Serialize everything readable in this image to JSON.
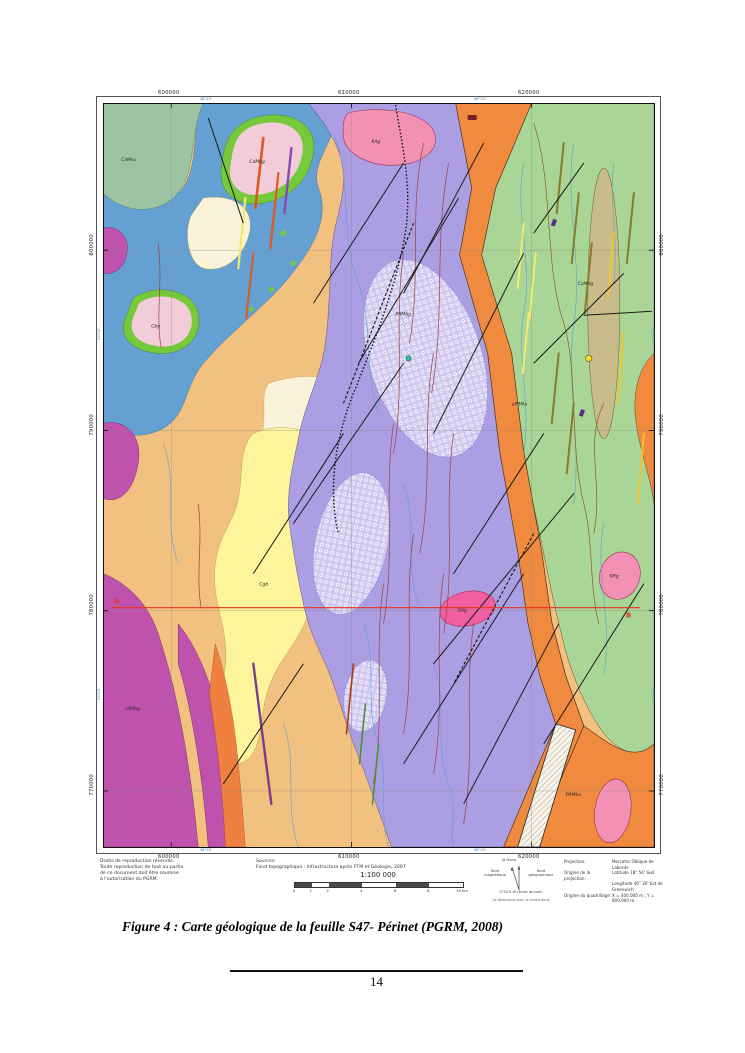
{
  "figure_caption": "Figure 4 : Carte géologique de la feuille S47- Périnet (PGRM, 2008)",
  "page_number": "14",
  "map": {
    "grid": {
      "top": [
        "600000",
        "610000",
        "620000"
      ],
      "bottom": [
        "600000",
        "610000",
        "620000"
      ],
      "left": [
        "800000",
        "790000",
        "780000",
        "770000"
      ],
      "right": [
        "800000",
        "790000",
        "780000",
        "770000"
      ],
      "geo_top": [
        "48°15'",
        "48°20'"
      ],
      "geo_bottom": [
        "48°15'",
        "48°20'"
      ],
      "geo_left": [
        "19°00'",
        "19°05'"
      ],
      "geo_right": [
        "19°00'",
        "19°05'"
      ]
    },
    "section": {
      "start": "A",
      "end": "B"
    },
    "units": [
      {
        "t": "CaMsu"
      },
      {
        "t": "CaMbg"
      },
      {
        "t": "Cbg"
      },
      {
        "t": "KAg"
      },
      {
        "t": "PRMbg"
      },
      {
        "t": "Gbg"
      },
      {
        "t": "KRg"
      },
      {
        "t": "rAMbg"
      },
      {
        "t": "PRMba"
      },
      {
        "t": "Cgb"
      },
      {
        "t": "uPRMa"
      },
      {
        "t": "CaMdg"
      }
    ]
  },
  "marginalia": {
    "copyright": [
      "Droits de reproduction réservés.",
      "Toute reproduction de tout ou partie",
      "de ce document doit être soumise",
      "à l'autorisation du PGRM."
    ],
    "sources_title": "Sources:",
    "sources_line": "Fond topographique : Infrastructure après FTM et Géologie, 2007",
    "scale_ratio": "1:100 000",
    "scale_ticks": [
      "0",
      "1",
      "2",
      "4",
      "6",
      "8",
      "10 km"
    ],
    "north": {
      "date": "(6 Mars)",
      "magnetic": "Nord magnétique",
      "geographic": "Nord géographique",
      "declination": "0°52'0 W (écart annuel)",
      "note": "La déclinaison pour le centre de la"
    },
    "projection": {
      "p_label": "Projection:",
      "p_value": "Mercator Oblique de Laborde",
      "o_label": "Origine de la projection:",
      "o_value1": "Latitude 18° 54' Sud",
      "o_value2": "Longitude 46° 26' Est de Greenwich",
      "q_label": "Origine du quadrillage:",
      "q_value": "X = 400.000 m ; Y = 800.000 m"
    }
  },
  "palette": {
    "tan_gneiss": "#f3c17f",
    "purple_migmatite": "#ab9ee2",
    "purple_textured": "#cfc7ef",
    "orange_band": "#ef8a3e",
    "green_east": "#a9d696",
    "sage_green": "#9dc4a2",
    "blue_water": "#64a0d2",
    "green_rim": "#76c93a",
    "pink_island": "#f3ccd9",
    "magenta_granite": "#bf52ad",
    "yellow_unit": "#fdf49c",
    "cream_unit": "#faf3da",
    "pink_intrusive": "#f291b4",
    "pink_bright": "#f25fa0",
    "khaki_oval": "#c9bc8b",
    "fault_black": "#1a1a1a",
    "fold_red": "#9c4040",
    "river_blue": "#5aa0d8",
    "section_red": "#e8321e"
  }
}
